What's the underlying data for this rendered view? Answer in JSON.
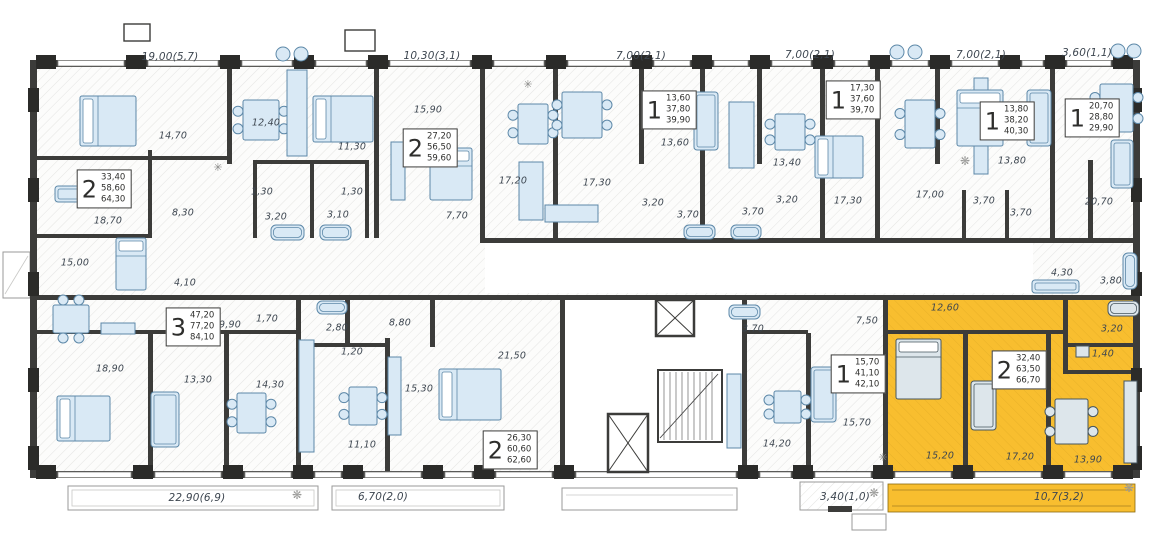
{
  "colors": {
    "highlight": "#F8BE2F",
    "wall": "#3C3C3A",
    "pier": "#2B2B29",
    "floor": "#FCFCFB",
    "hatch": "#E5E5E3",
    "furniture_fill": "#D9E9F5",
    "furniture_stroke": "#5D88A8",
    "highlight_furniture_fill": "#DDE6EB",
    "highlight_furniture_stroke": "#46565F",
    "label_text": "#3D4650"
  },
  "icons": {
    "light": "✳",
    "plant": "❋"
  },
  "apartments": [
    {
      "rooms": "2",
      "living": "33,40",
      "usable": "58,60",
      "total": "64,30",
      "x": 104,
      "y": 189,
      "highlighted": false
    },
    {
      "rooms": "2",
      "living": "27,20",
      "usable": "56,50",
      "total": "59,60",
      "x": 430,
      "y": 148,
      "highlighted": false
    },
    {
      "rooms": "1",
      "living": "13,60",
      "usable": "37,80",
      "total": "39,90",
      "x": 669,
      "y": 110,
      "highlighted": false
    },
    {
      "rooms": "1",
      "living": "17,30",
      "usable": "37,60",
      "total": "39,70",
      "x": 853,
      "y": 100,
      "highlighted": false
    },
    {
      "rooms": "1",
      "living": "13,80",
      "usable": "38,20",
      "total": "40,30",
      "x": 1007,
      "y": 121,
      "highlighted": false
    },
    {
      "rooms": "1",
      "living": "20,70",
      "usable": "28,80",
      "total": "29,90",
      "x": 1092,
      "y": 118,
      "highlighted": false
    },
    {
      "rooms": "3",
      "living": "47,20",
      "usable": "77,20",
      "total": "84,10",
      "x": 193,
      "y": 327,
      "highlighted": false
    },
    {
      "rooms": "2",
      "living": "26,30",
      "usable": "60,60",
      "total": "62,60",
      "x": 510,
      "y": 450,
      "highlighted": false
    },
    {
      "rooms": "1",
      "living": "15,70",
      "usable": "41,10",
      "total": "42,10",
      "x": 858,
      "y": 374,
      "highlighted": false
    },
    {
      "rooms": "2",
      "living": "32,40",
      "usable": "63,50",
      "total": "66,70",
      "x": 1019,
      "y": 370,
      "highlighted": true
    }
  ],
  "room_labels": [
    {
      "t": "14,70",
      "x": 173,
      "y": 136
    },
    {
      "t": "12,40",
      "x": 266,
      "y": 123
    },
    {
      "t": "18,70",
      "x": 108,
      "y": 221
    },
    {
      "t": "8,30",
      "x": 183,
      "y": 213
    },
    {
      "t": "15,00",
      "x": 75,
      "y": 263
    },
    {
      "t": "1,30",
      "x": 262,
      "y": 192
    },
    {
      "t": "3,20",
      "x": 276,
      "y": 217
    },
    {
      "t": "3,10",
      "x": 338,
      "y": 215
    },
    {
      "t": "1,30",
      "x": 352,
      "y": 192
    },
    {
      "t": "11,30",
      "x": 352,
      "y": 147
    },
    {
      "t": "4,10",
      "x": 185,
      "y": 283
    },
    {
      "t": "15,90",
      "x": 428,
      "y": 110
    },
    {
      "t": "7,70",
      "x": 457,
      "y": 216
    },
    {
      "t": "17,20",
      "x": 513,
      "y": 181
    },
    {
      "t": "17,30",
      "x": 597,
      "y": 183
    },
    {
      "t": "13,60",
      "x": 675,
      "y": 143
    },
    {
      "t": "3,20",
      "x": 653,
      "y": 203
    },
    {
      "t": "3,70",
      "x": 688,
      "y": 215
    },
    {
      "t": "3,70",
      "x": 753,
      "y": 212
    },
    {
      "t": "13,40",
      "x": 787,
      "y": 163
    },
    {
      "t": "3,20",
      "x": 787,
      "y": 200
    },
    {
      "t": "17,30",
      "x": 848,
      "y": 201
    },
    {
      "t": "17,00",
      "x": 930,
      "y": 195
    },
    {
      "t": "13,80",
      "x": 1012,
      "y": 161
    },
    {
      "t": "3,70",
      "x": 984,
      "y": 201
    },
    {
      "t": "3,70",
      "x": 1021,
      "y": 213
    },
    {
      "t": "20,70",
      "x": 1099,
      "y": 202
    },
    {
      "t": "4,30",
      "x": 1062,
      "y": 273
    },
    {
      "t": "3,80",
      "x": 1111,
      "y": 281
    },
    {
      "t": "12,60",
      "x": 945,
      "y": 308
    },
    {
      "t": "3,20",
      "x": 1112,
      "y": 329
    },
    {
      "t": "1,40",
      "x": 1103,
      "y": 354
    },
    {
      "t": "15,20",
      "x": 940,
      "y": 456
    },
    {
      "t": "17,20",
      "x": 1020,
      "y": 457
    },
    {
      "t": "13,90",
      "x": 1088,
      "y": 460
    },
    {
      "t": "9,90",
      "x": 230,
      "y": 325
    },
    {
      "t": "1,70",
      "x": 267,
      "y": 319
    },
    {
      "t": "18,90",
      "x": 110,
      "y": 369
    },
    {
      "t": "13,30",
      "x": 198,
      "y": 380
    },
    {
      "t": "14,30",
      "x": 270,
      "y": 385
    },
    {
      "t": "2,80",
      "x": 337,
      "y": 328
    },
    {
      "t": "8,80",
      "x": 400,
      "y": 323
    },
    {
      "t": "1,20",
      "x": 352,
      "y": 352
    },
    {
      "t": "15,30",
      "x": 419,
      "y": 389
    },
    {
      "t": "21,50",
      "x": 512,
      "y": 356
    },
    {
      "t": "11,10",
      "x": 362,
      "y": 445
    },
    {
      "t": "3,70",
      "x": 753,
      "y": 329
    },
    {
      "t": "7,50",
      "x": 867,
      "y": 321
    },
    {
      "t": "14,20",
      "x": 777,
      "y": 444
    },
    {
      "t": "15,70",
      "x": 857,
      "y": 423
    }
  ],
  "dimension_labels": [
    {
      "t": "19,00(5,7)",
      "x": 170,
      "y": 57
    },
    {
      "t": "10,30(3,1)",
      "x": 432,
      "y": 56
    },
    {
      "t": "7,00(2,1)",
      "x": 641,
      "y": 56
    },
    {
      "t": "7,00(2,1)",
      "x": 810,
      "y": 55
    },
    {
      "t": "7,00(2,1)",
      "x": 981,
      "y": 55
    },
    {
      "t": "3,60(1,1)",
      "x": 1087,
      "y": 53
    },
    {
      "t": "22,90(6,9)",
      "x": 197,
      "y": 498
    },
    {
      "t": "6,70(2,0)",
      "x": 383,
      "y": 497
    },
    {
      "t": "3,40(1,0)",
      "x": 845,
      "y": 497
    },
    {
      "t": "10,7(3,2)",
      "x": 1059,
      "y": 497
    }
  ]
}
